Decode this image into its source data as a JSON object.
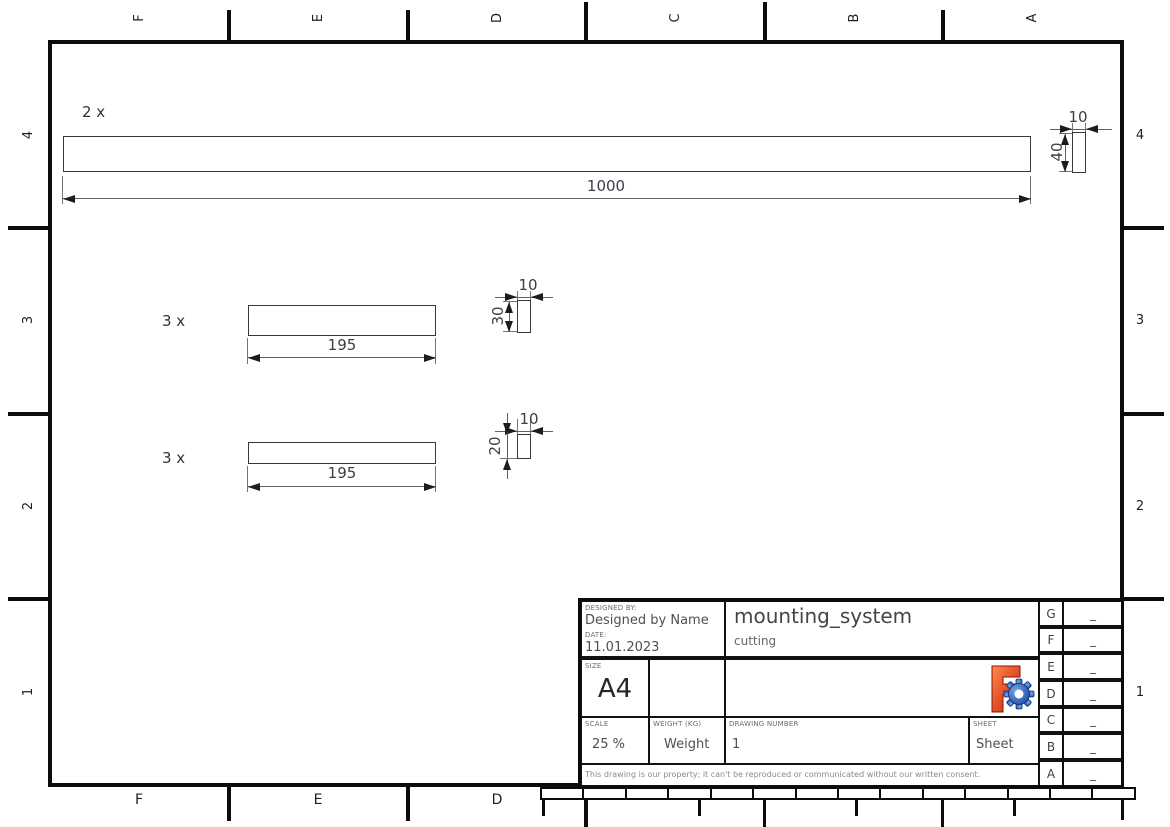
{
  "grid": {
    "top": [
      "F",
      "E",
      "D",
      "C",
      "B",
      "A"
    ],
    "bottom": [
      "F",
      "E",
      "D"
    ],
    "left": [
      "4",
      "3",
      "2",
      "1"
    ],
    "right": [
      "4",
      "3",
      "2",
      "1"
    ]
  },
  "views": {
    "bar1000": {
      "qty": "2 x",
      "len": "1000"
    },
    "bar195a": {
      "qty": "3 x",
      "len": "195"
    },
    "bar195b": {
      "qty": "3 x",
      "len": "195"
    },
    "sec40": {
      "w": "10",
      "h": "40"
    },
    "sec30": {
      "w": "10",
      "h": "30"
    },
    "sec20": {
      "w": "10",
      "h": "20"
    }
  },
  "title_block": {
    "designed_by_label": "DESIGNED BY:",
    "designed_by": "Designed by Name",
    "date_label": "DATE:",
    "date": "11.01.2023",
    "size_label": "SIZE",
    "size": "A4",
    "title": "mounting_system",
    "subtitle": "cutting",
    "scale_label": "SCALE",
    "scale": "25 %",
    "weight_label": "WEIGHT (KG)",
    "weight": "Weight",
    "drawing_number_label": "DRAWING NUMBER",
    "drawing_number": "1",
    "sheet_label": "SHEET",
    "sheet": "Sheet",
    "disclaimer": "This drawing is our property; it can't be reproduced or communicated without our written consent.",
    "logo": "freecad-logo"
  },
  "revision": {
    "rows": [
      {
        "letter": "G",
        "value": "_"
      },
      {
        "letter": "F",
        "value": "_"
      },
      {
        "letter": "E",
        "value": "_"
      },
      {
        "letter": "D",
        "value": "_"
      },
      {
        "letter": "C",
        "value": "_"
      },
      {
        "letter": "B",
        "value": "_"
      },
      {
        "letter": "A",
        "value": "_"
      }
    ]
  },
  "colors": {
    "line": "#101010",
    "logo_orange": "#d6401e",
    "logo_blue": "#1e4fa8"
  }
}
